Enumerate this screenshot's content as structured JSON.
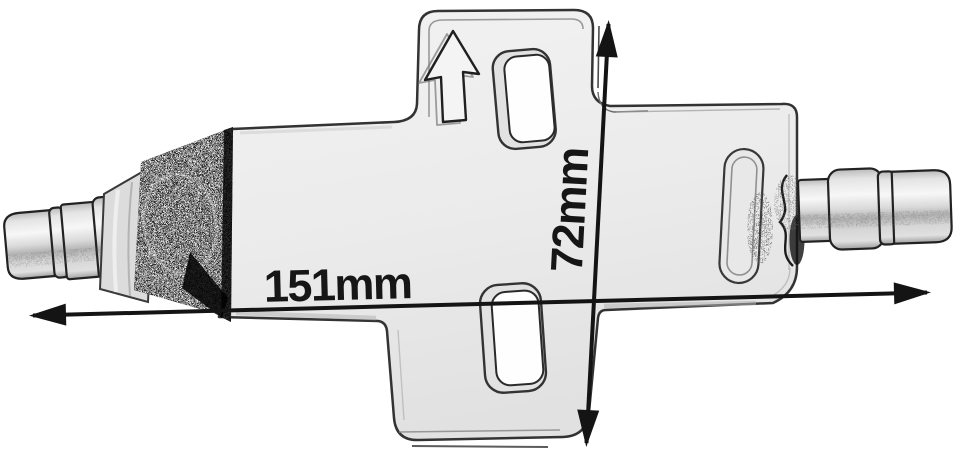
{
  "labels": {
    "width_dimension": "151mm",
    "height_dimension": "72mm"
  },
  "icons": {
    "flow_direction": "up-arrow-icon",
    "width_arrow": "double-headed-horizontal-arrow-icon",
    "height_arrow": "double-headed-vertical-arrow-icon"
  },
  "colors": {
    "background": "#ffffff",
    "dimension_line": "#141414",
    "label_text": "#161616",
    "plate_outline": "#333333",
    "dark_shading": "#2e2e2e"
  }
}
